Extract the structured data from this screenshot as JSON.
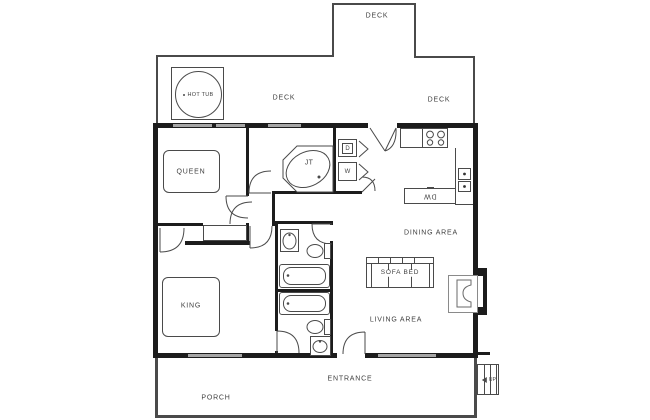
{
  "floor_plan": {
    "labels": {
      "deck_top": "DECK",
      "deck_main": "DECK",
      "deck_right": "DECK",
      "hot_tub": "HOT TUB",
      "queen_bed": "QUEEN",
      "king_bed": "KING",
      "jetted_tub": "JT",
      "dryer": "D",
      "washer": "W",
      "dishwasher": "DW",
      "dining_area": "DINING AREA",
      "sofa_bed": "SOFA BED",
      "living_area": "LIVING AREA",
      "entrance": "ENTRANCE",
      "porch": "PORCH",
      "stairs_up": "UP"
    },
    "colors": {
      "wall": "#1c1c1c",
      "fixture_line": "#4a4a4a",
      "window": "#a6a6a6",
      "background": "#ffffff",
      "label_text": "#3f3f3f"
    }
  }
}
